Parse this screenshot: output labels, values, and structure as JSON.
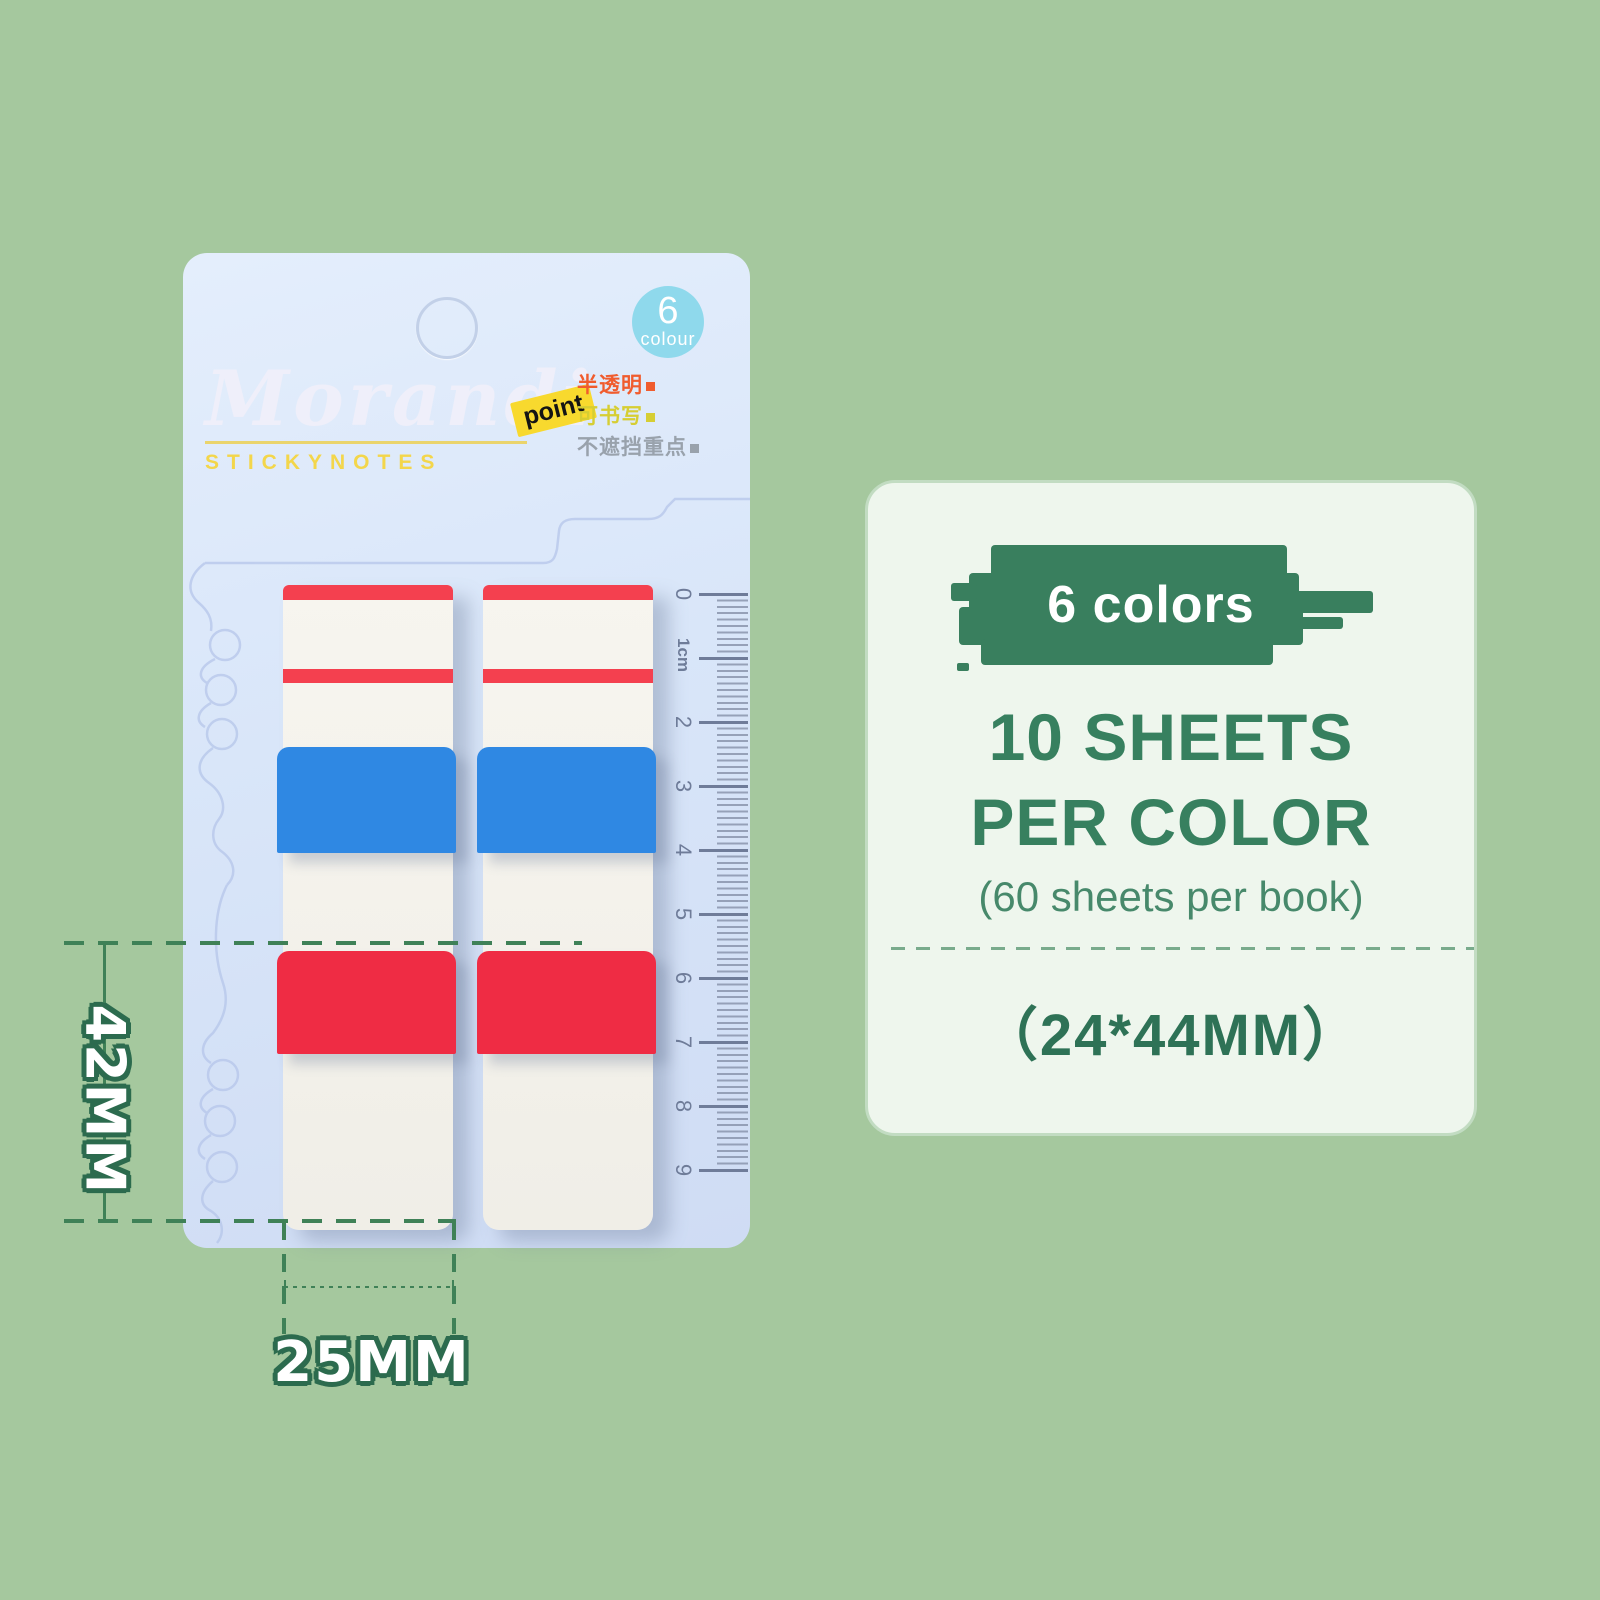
{
  "colors": {
    "background": "#a5c89e",
    "card": "#d9e6f8",
    "stripe_red": "#f4404f",
    "tab_blue": "#2f88e3",
    "tab_red": "#ef2c44",
    "badge_blue": "#8fd9ec",
    "brand_yellow": "#f3d64b",
    "brush_green": "#397f5e",
    "headline_green": "#37805f",
    "dimension_green": "#3f8157"
  },
  "package": {
    "badge": {
      "count": "6",
      "unit": "colour"
    },
    "brand": {
      "script": "Morandi",
      "subtitle": "STICKYNOTES",
      "point_tag": "point"
    },
    "features": [
      {
        "text": "半透明",
        "color": "#f05c2e"
      },
      {
        "text": "可书写",
        "color": "#d6ce33"
      },
      {
        "text": "不遮挡重点",
        "color": "#99a2ac"
      }
    ],
    "ruler": {
      "labels": [
        "0",
        "1cm",
        "2",
        "3",
        "4",
        "5",
        "6",
        "7",
        "8",
        "9"
      ]
    }
  },
  "dimensions": {
    "height": "42MM",
    "width": "25MM"
  },
  "info_panel": {
    "highlight": "6 colors",
    "headline_line1": "10 SHEETS",
    "headline_line2": "PER COLOR",
    "note": "(60 sheets per book)",
    "size": "（24*44MM）"
  }
}
